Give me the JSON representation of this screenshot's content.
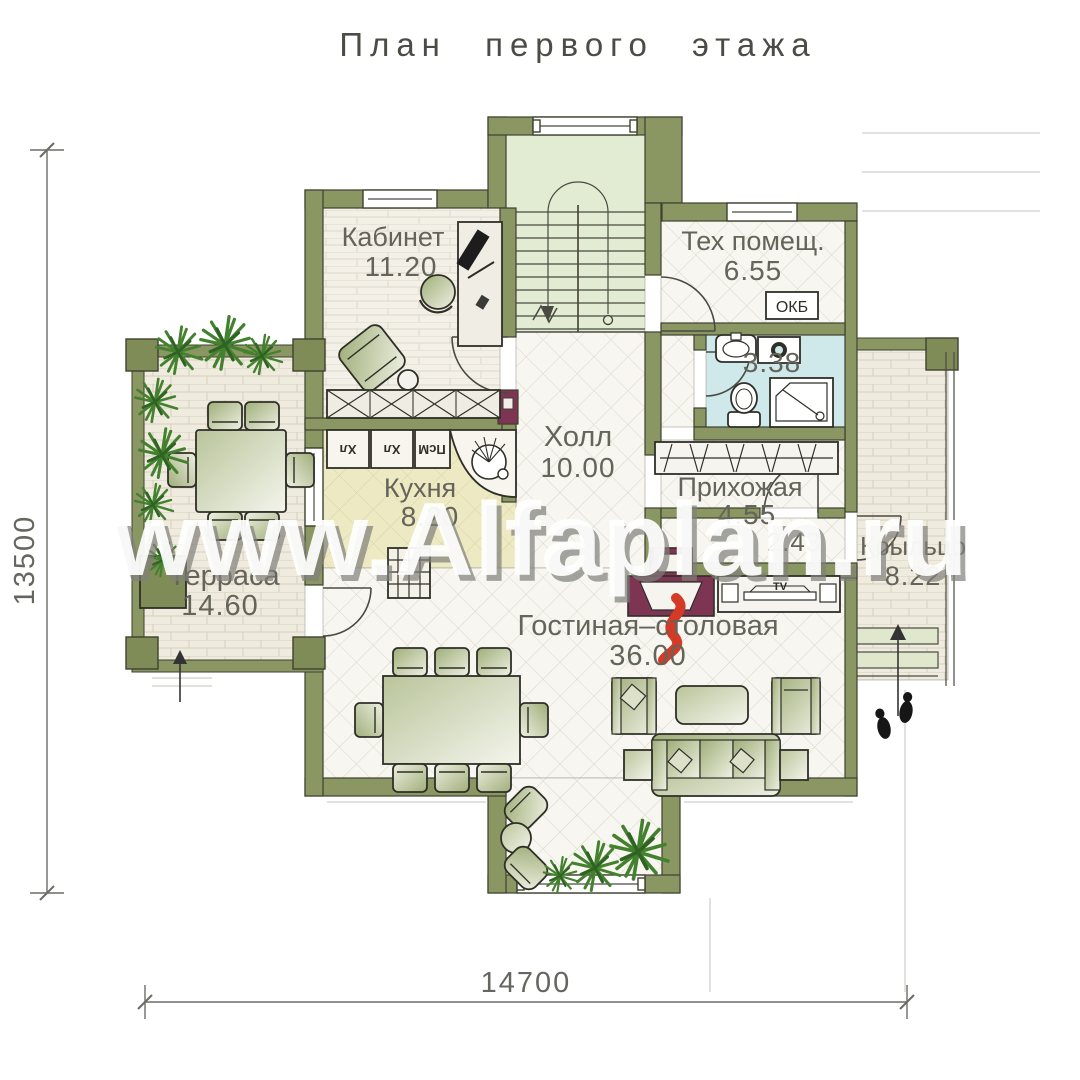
{
  "title": "План первого этажа",
  "watermark": "www.Alfaplan.ru",
  "dimensions": {
    "height": "13500",
    "width": "14700"
  },
  "rooms": {
    "kabinet": {
      "name": "Кабинет",
      "area": "11.20"
    },
    "teh": {
      "name": "Тех помещ.",
      "area": "6.55"
    },
    "holl": {
      "name": "Холл",
      "area": "10.00"
    },
    "sanuzel": {
      "area": "3.38"
    },
    "prihozhaya": {
      "name": "Прихожая",
      "area": "4.55"
    },
    "tambur": {
      "area": "2.43"
    },
    "kuhnya": {
      "name": "Кухня",
      "area": "8.20"
    },
    "terrasa": {
      "name": "Терраса",
      "area": "14.60"
    },
    "gostinaya": {
      "name": "Гостиная–столовая",
      "area": "36.00"
    },
    "kryltso": {
      "name": "Крыльцо",
      "area": "8.22"
    }
  },
  "equipment": {
    "okb": "ОКБ",
    "tv": "TV",
    "kitchen_units": [
      "Хл",
      "Хл",
      "ПсМ"
    ]
  },
  "colors": {
    "wall": "#8b9763",
    "bath_floor": "#cfe8ea",
    "kitchen_floor": "#edeac3",
    "stair_floor": "#e2ecd3",
    "fireplace": "#7d3553",
    "flame": "#d43a26"
  }
}
